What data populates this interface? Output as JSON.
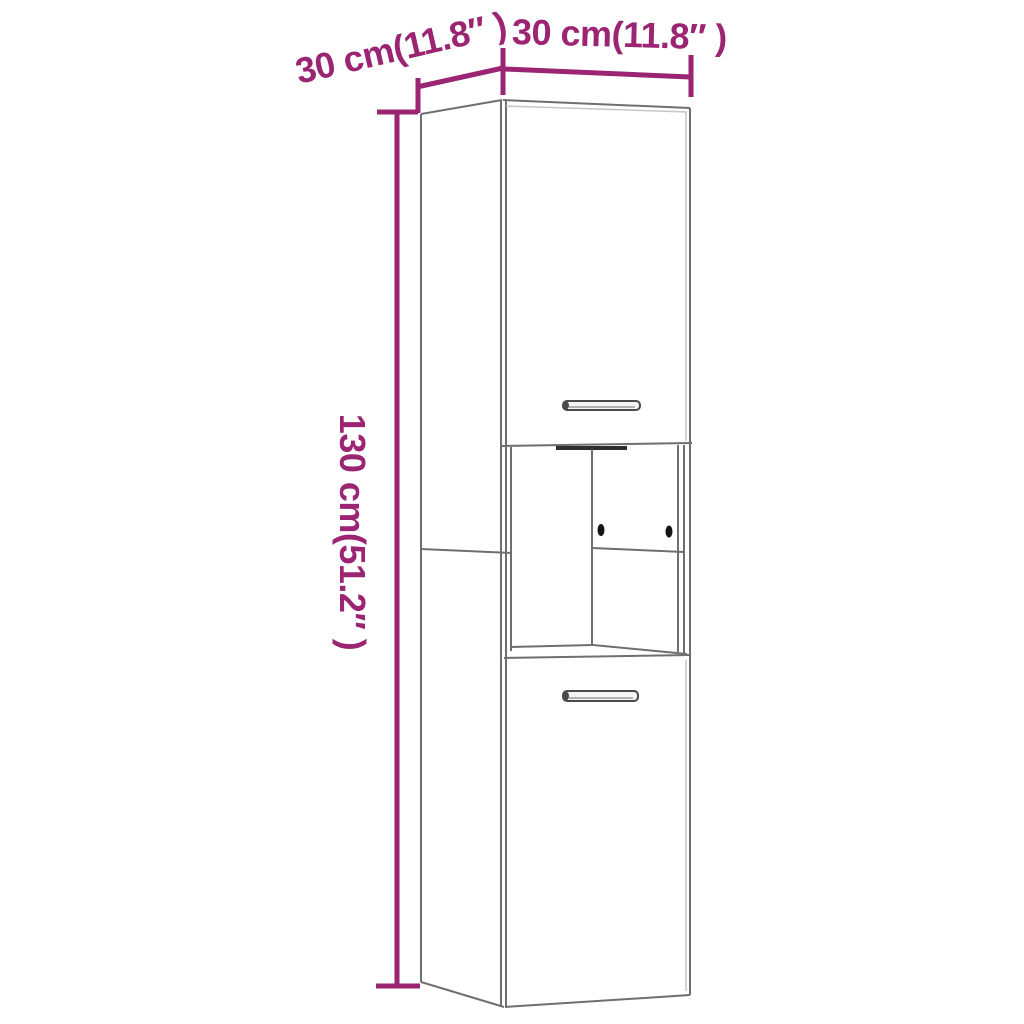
{
  "figure": {
    "kind": "furniture-dimension-diagram",
    "item": "tall-cabinet-with-two-doors-and-open-shelf"
  },
  "dimensions": {
    "depth_label": "30 cm(11.8″ )",
    "width_label": "30 cm(11.8″ )",
    "height_label": "130 cm(51.2″ )",
    "depth_cm": 30,
    "width_cm": 30,
    "height_cm": 130,
    "depth_in": 11.8,
    "width_in": 11.8,
    "height_in": 51.2
  },
  "colors": {
    "dimension_accent": "#9B2573",
    "cabinet_outline": "#6F6F6F",
    "dark_shadow": "#2E2E2E",
    "background": "#FFFFFF"
  }
}
